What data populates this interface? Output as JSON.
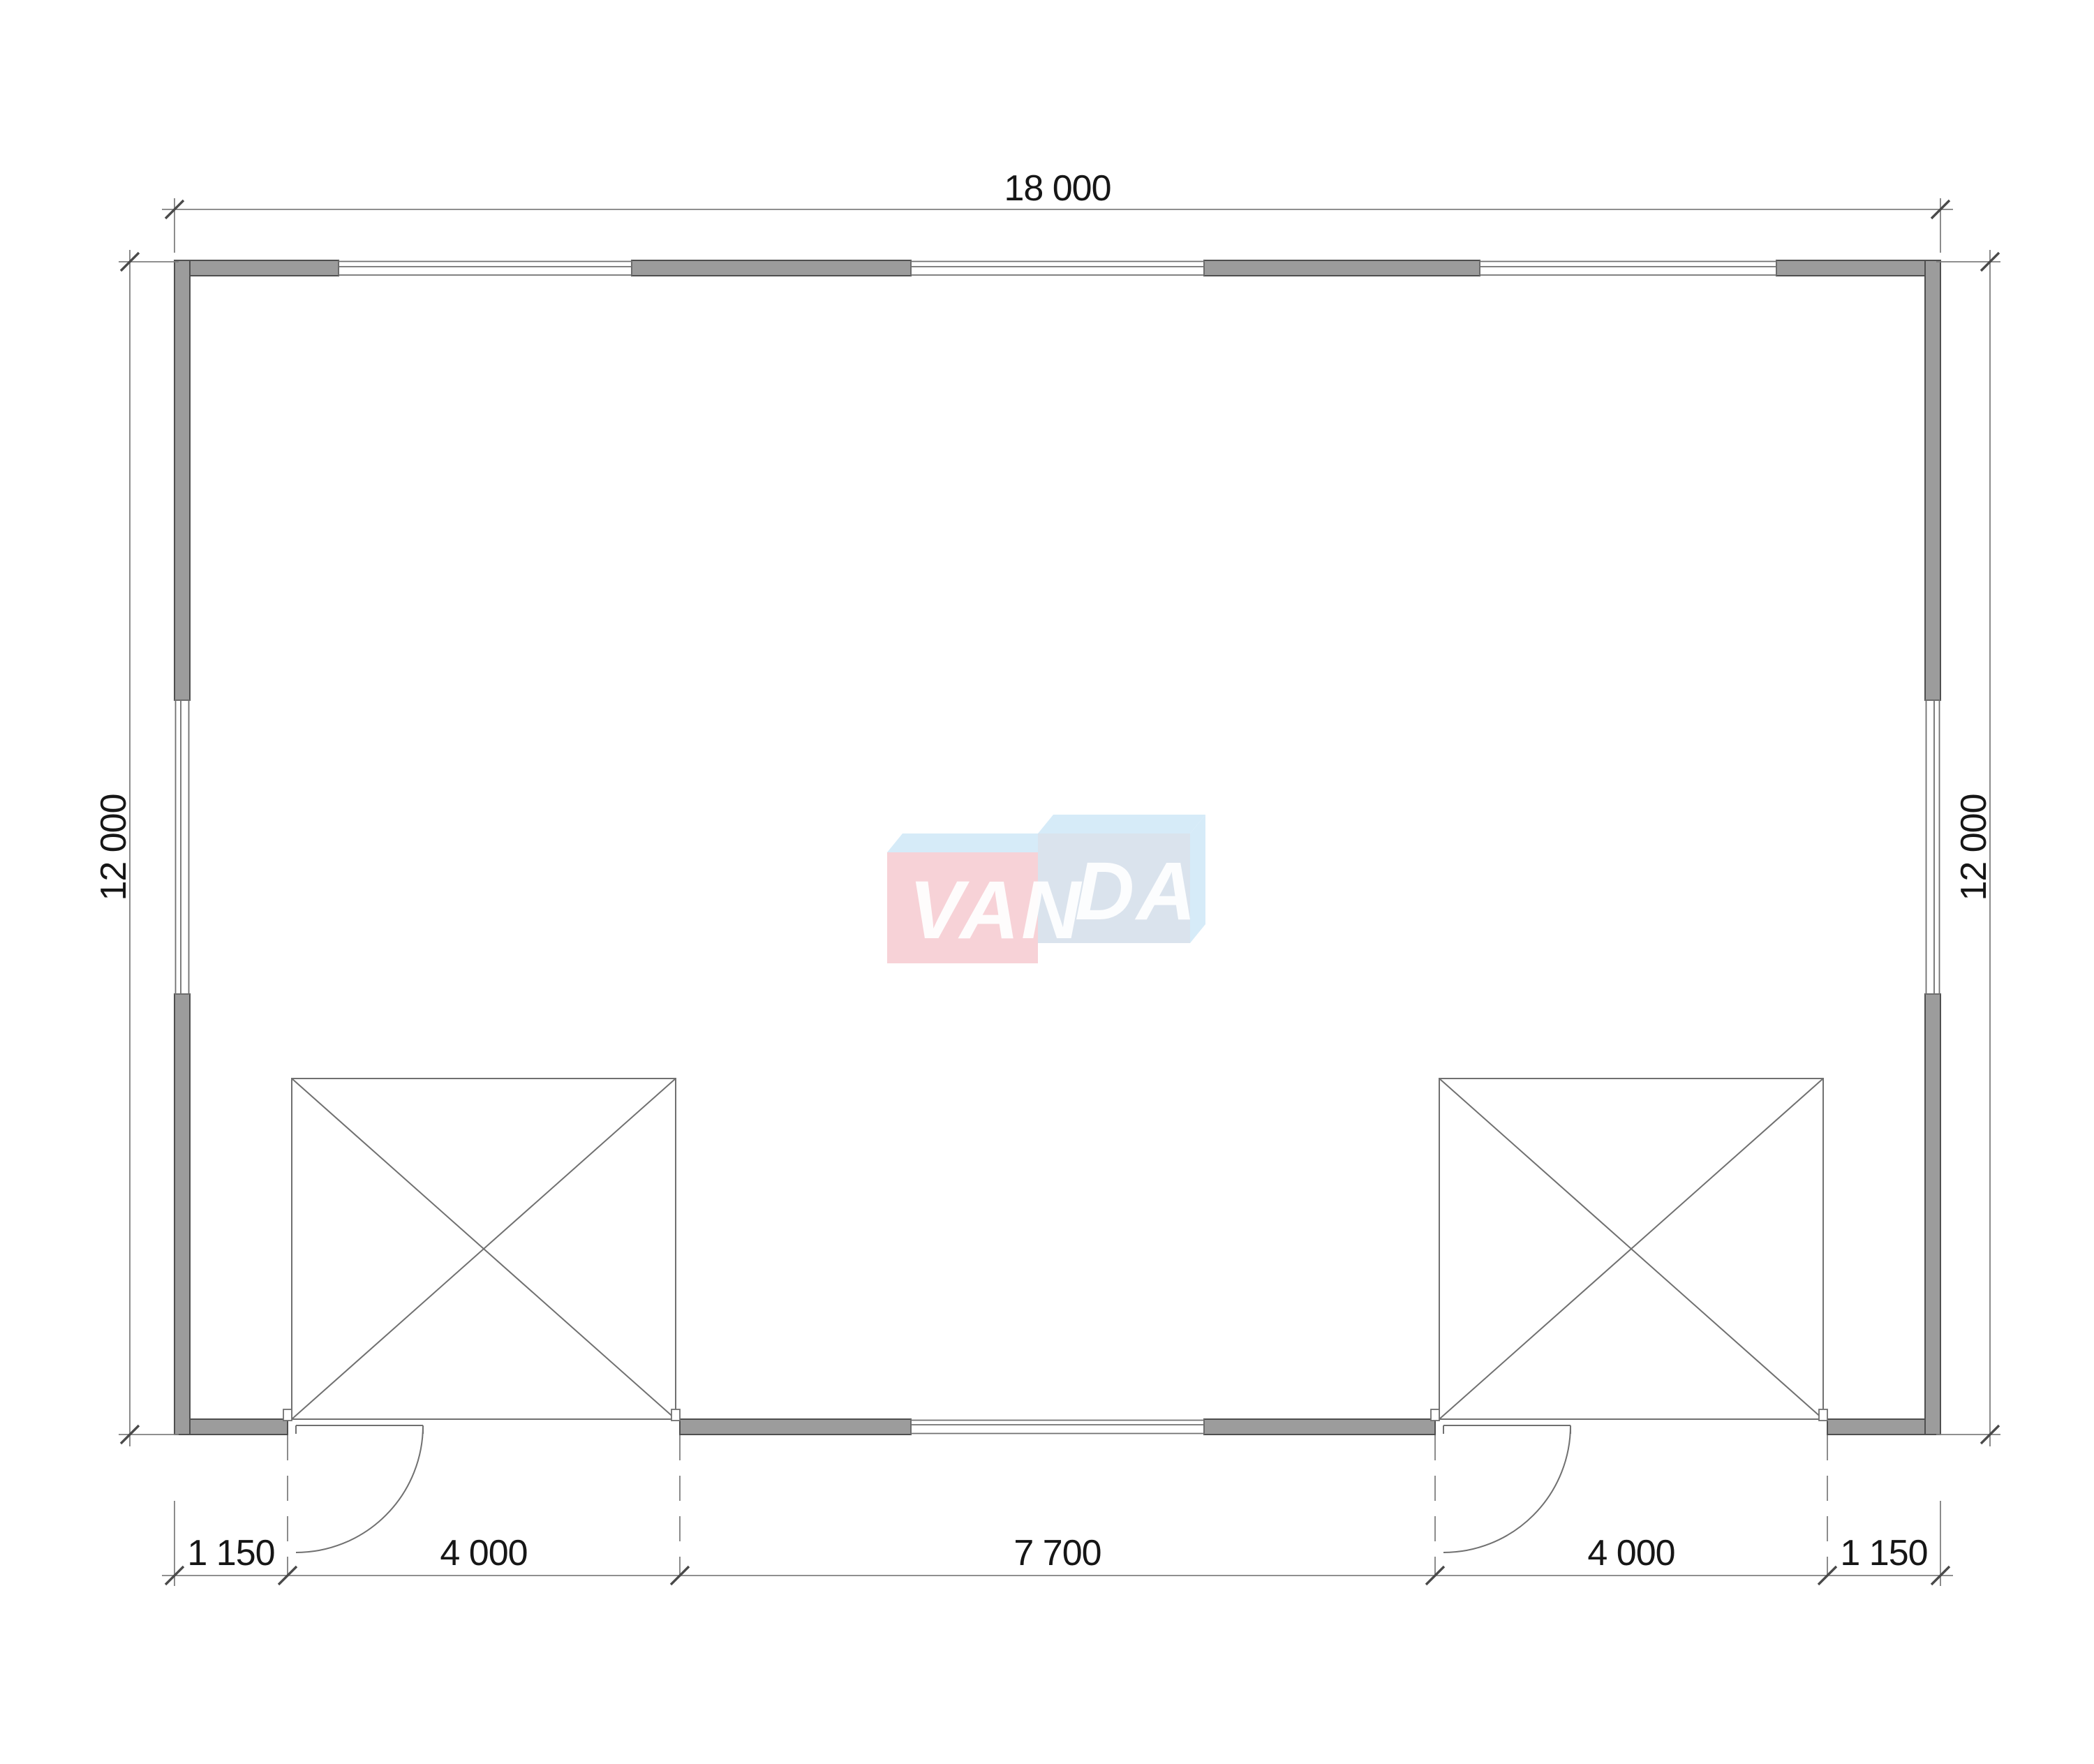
{
  "plan": {
    "dimensions": {
      "top": "18 000",
      "left": "12 000",
      "right": "12 000",
      "bottom": [
        "1 150",
        "4 000",
        "7 700",
        "4 000",
        "1 150"
      ]
    },
    "watermark": {
      "text_left": "VAN",
      "text_right": "DA"
    },
    "colors": {
      "wall-fill": "#9c9c9c",
      "wall-edge": "#4f4f4f",
      "line": "#707070",
      "dim-line": "#7f7f7f",
      "tick": "#4a4a4a",
      "text": "#161616",
      "wm-pink": "#f7ced3",
      "wm-blue-front": "#d6e0ec",
      "wm-blue-top": "#d2e9f8",
      "wm-text": "#ffffff"
    }
  }
}
